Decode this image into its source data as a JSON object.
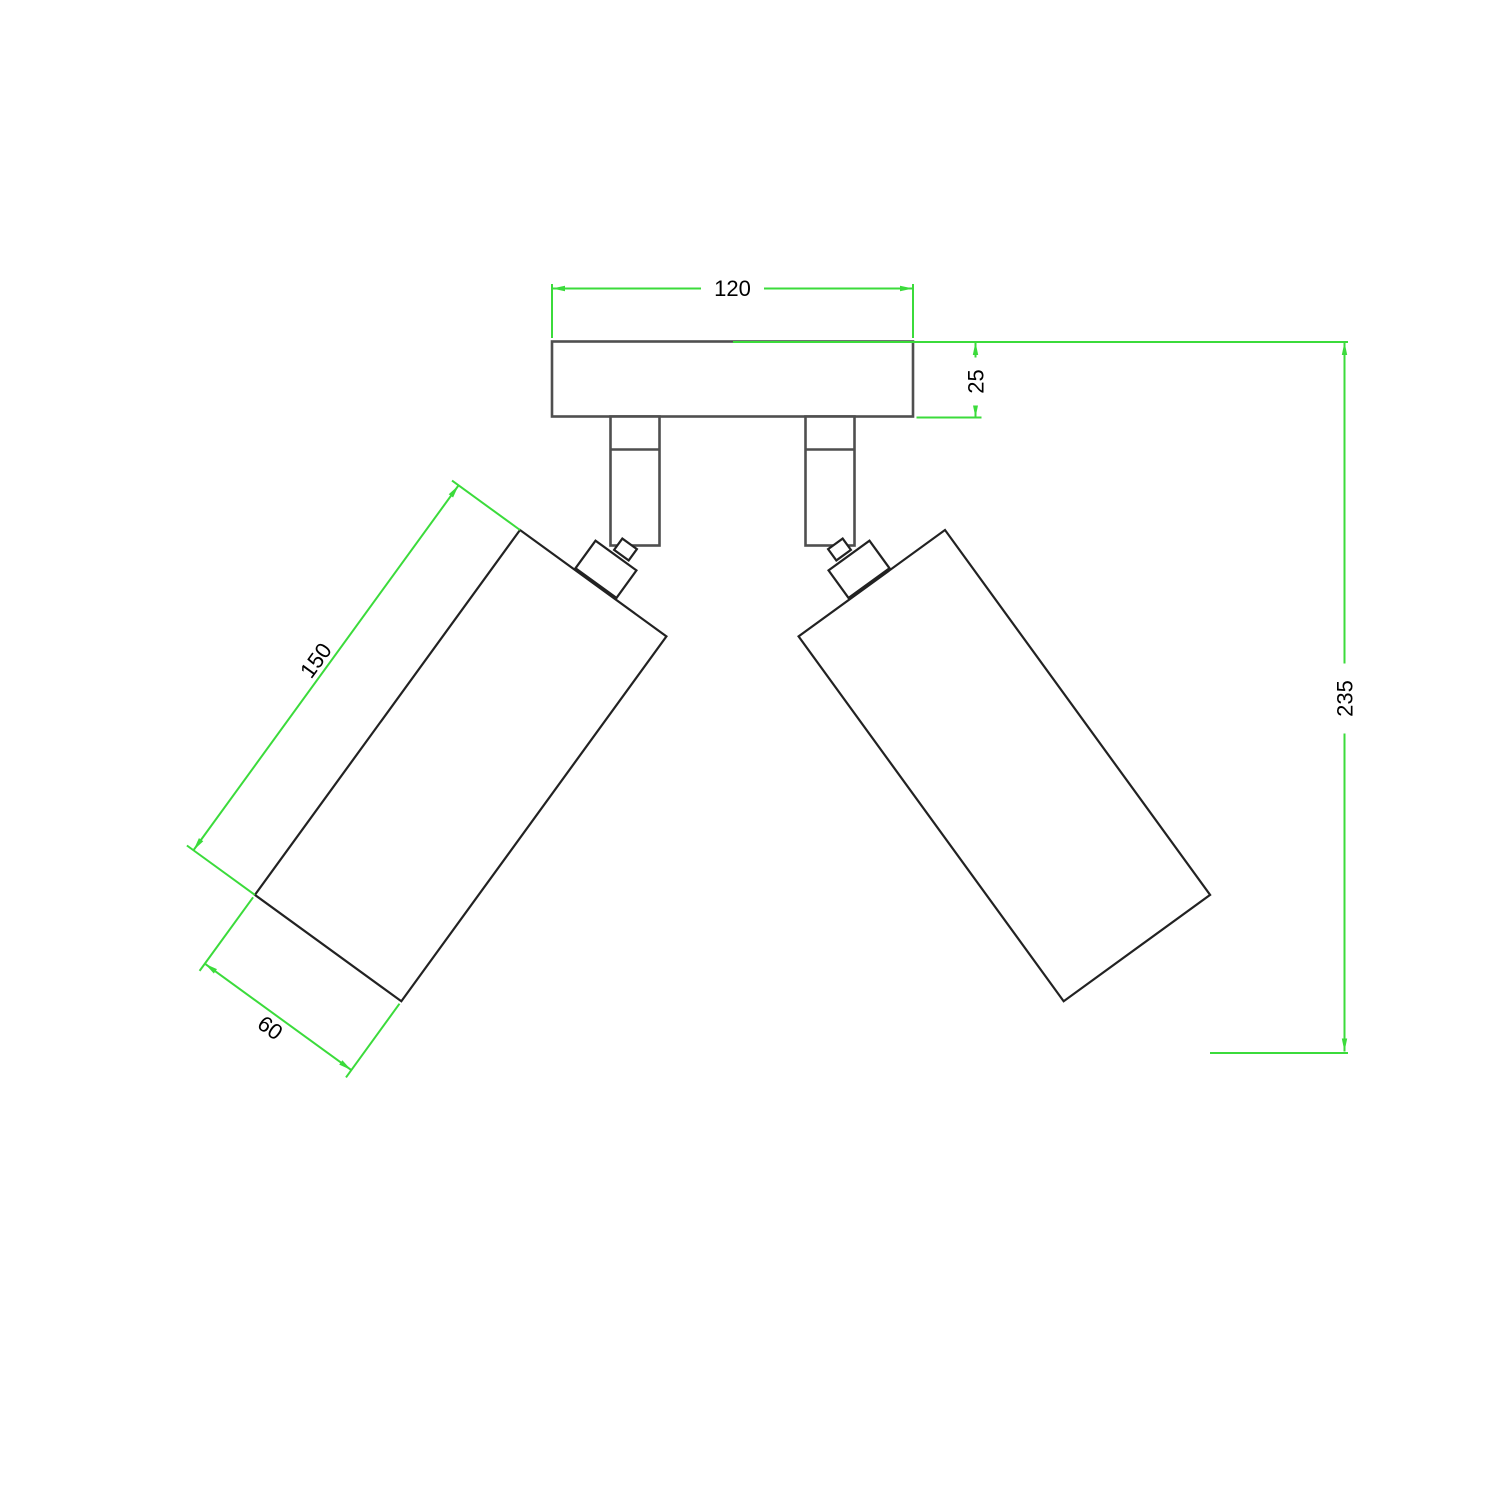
{
  "drawing": {
    "background_color": "#ffffff",
    "colors": {
      "dimension_lines": "#3bdb3b",
      "object_outline_dark": "#222222",
      "object_outline_gray": "#4f4f4f",
      "dimension_text": "#000000"
    },
    "dimensions": {
      "canopy_width": "120",
      "canopy_thickness": "25",
      "overall_height": "235",
      "spotlight_length": "150",
      "spotlight_diameter": "60"
    }
  }
}
